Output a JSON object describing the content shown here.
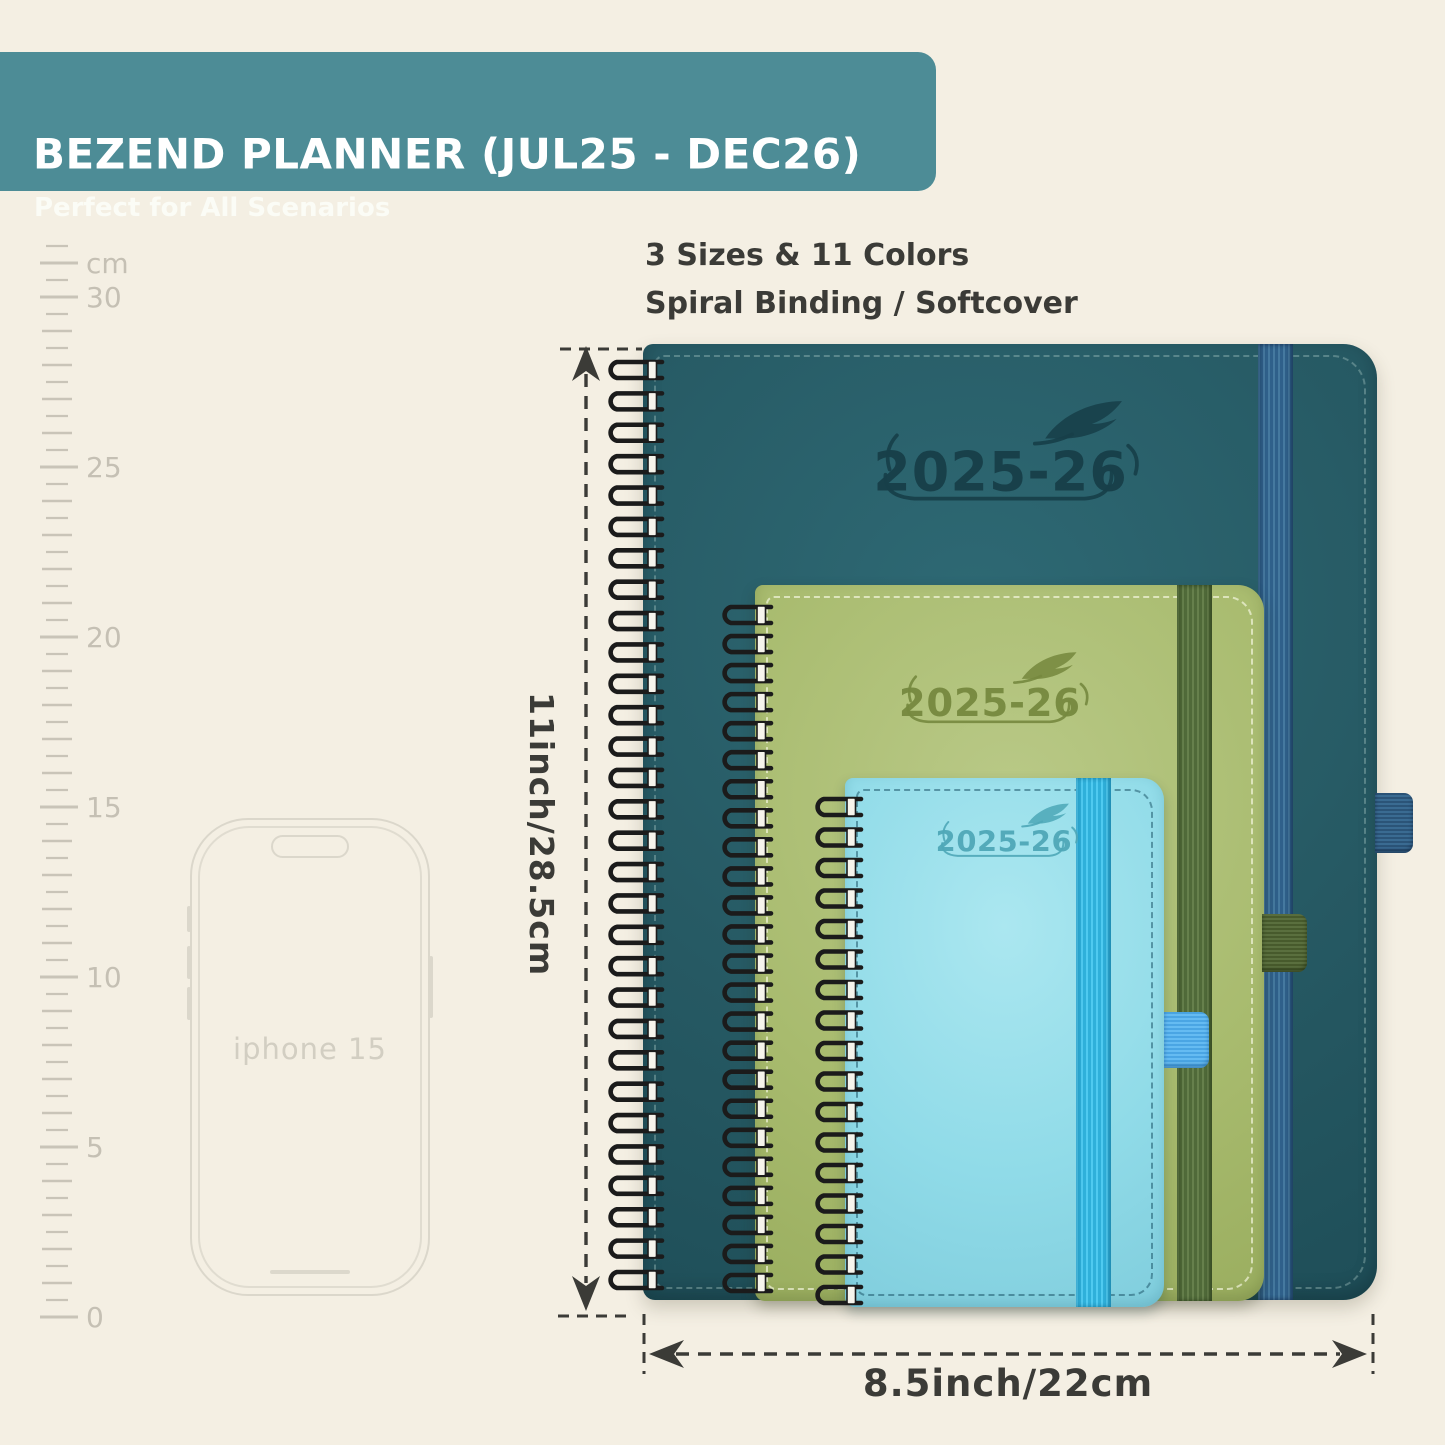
{
  "header": {
    "title": "BEZEND PLANNER (JUL25 - DEC26)",
    "subtitle": "Perfect for All Scenarios"
  },
  "features": {
    "line1": "3 Sizes & 11 Colors",
    "line2": "Spiral Binding / Softcover"
  },
  "ruler": {
    "unit": "cm",
    "labels": [
      "30",
      "25",
      "20",
      "15",
      "10",
      "5",
      "0"
    ]
  },
  "phone": {
    "label": "iphone 15"
  },
  "planners": [
    {
      "name": "large-teal",
      "cover_text": "2025-26",
      "cover_color": "#265963",
      "strap_color": "#3c7093",
      "logo_color": "#173f49"
    },
    {
      "name": "medium-green",
      "cover_text": "2025-26",
      "cover_color": "#a8bb6e",
      "strap_color": "#5e7a49",
      "logo_color": "#76893f"
    },
    {
      "name": "small-blue",
      "cover_text": "2025-26",
      "cover_color": "#90dbe8",
      "strap_color": "#3fc1e9",
      "logo_color": "#4fa8b8"
    }
  ],
  "dimensions": {
    "height_label": "11inch/28.5cm",
    "width_label": "8.5inch/22cm"
  },
  "colors": {
    "background": "#f4efe3",
    "banner": "#4d8c96",
    "annotation": "#3b3b37",
    "ruler": "#c9c4b8"
  }
}
